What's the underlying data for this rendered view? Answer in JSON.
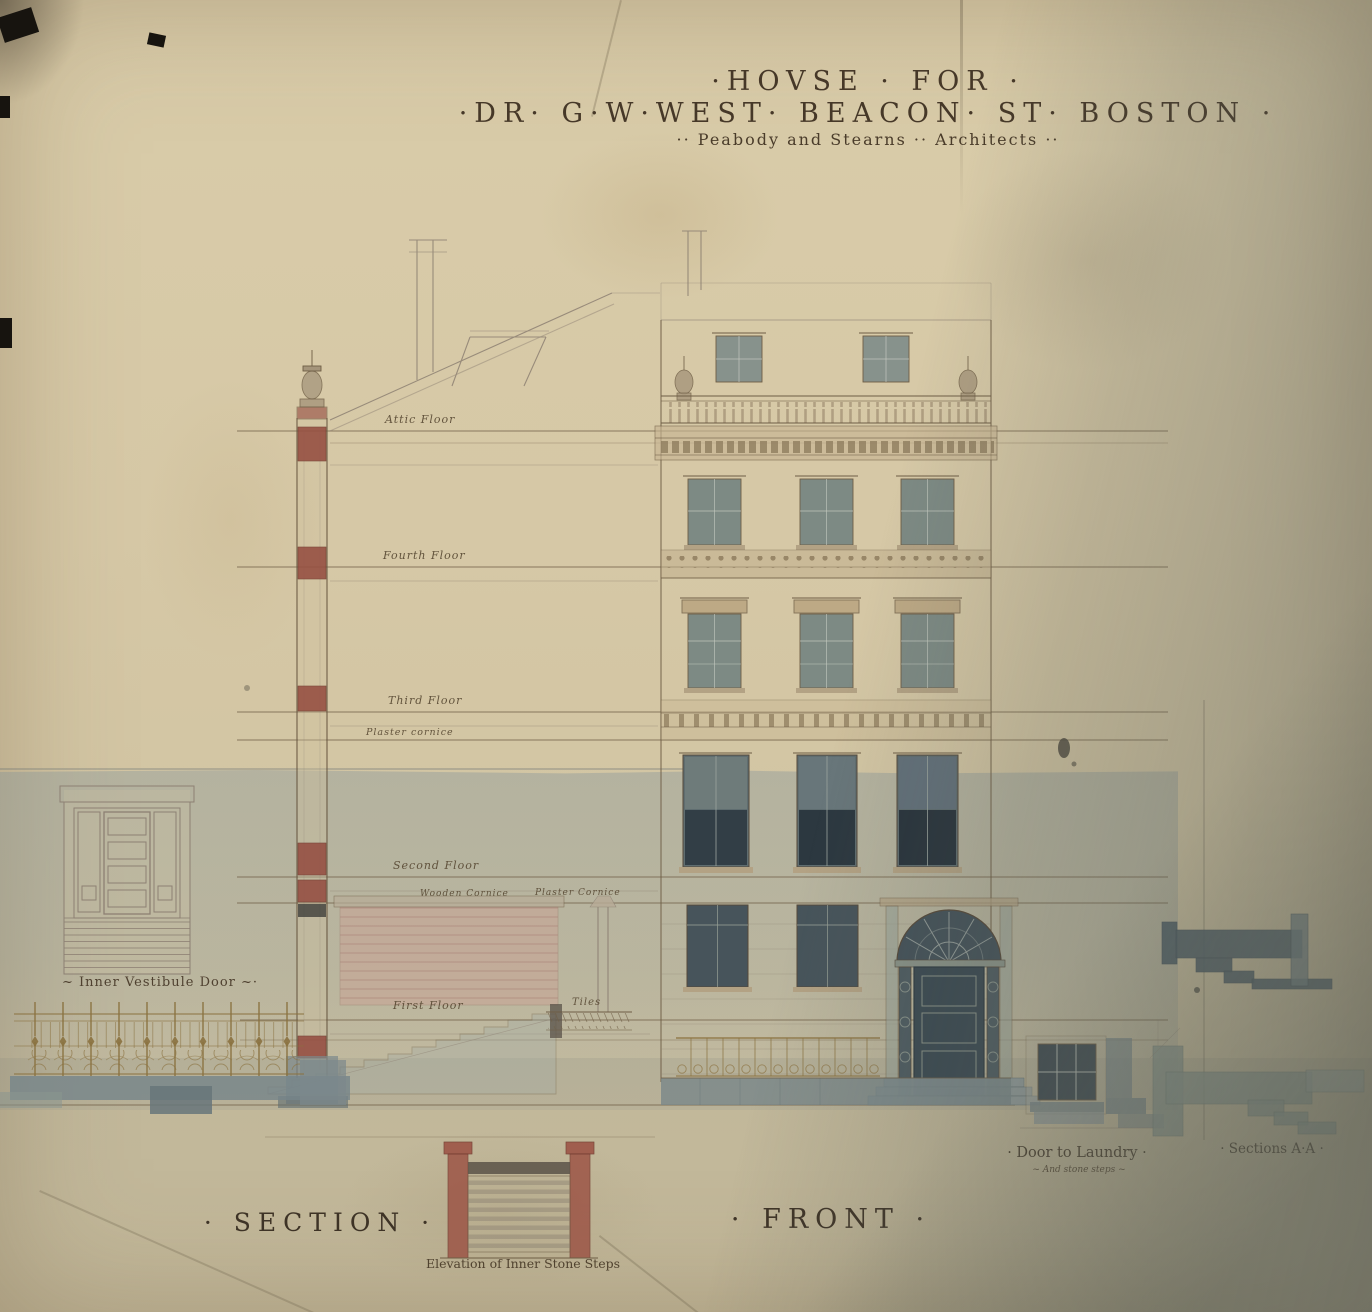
{
  "document": {
    "title_line1": "·HOVSE · FOR ·",
    "title_line2": "·DR· G·W·WEST·  BEACON· ST· BOSTON ·",
    "title_line3": "·· Peabody and Stearns ·· Architects ··"
  },
  "section_view": {
    "name_label": "· SECTION ·",
    "floor_labels": {
      "attic": "Attic Floor",
      "fourth": "Fourth Floor",
      "third": "Third Floor",
      "plaster_cornice": "Plaster cornice",
      "second": "Second Floor",
      "wooden_cornice": "Wooden Cornice",
      "plaster_cornice2": "Plaster Cornice",
      "first": "First Floor",
      "tiles": "Tiles"
    }
  },
  "front_view": {
    "name_label": "· FRONT ·"
  },
  "details": {
    "inner_vestibule_door_label": "~ Inner Vestibule Door ~·",
    "inner_stone_steps_label": "Elevation of Inner Stone Steps",
    "door_to_laundry_label": "· Door to Laundry ·",
    "door_to_laundry_sub_label": "~ And stone steps ~",
    "section_aa_label": "· Sections A·A ·"
  },
  "colors": {
    "paper": "#d6c8a6",
    "wash_blue": "#7a8e98",
    "ink_sepia": "#6e5d45",
    "pencil": "#8d8073",
    "brick_red": "#934a3e",
    "glass": "#7d8a84",
    "glass_dark": "#323e46",
    "stone_gray": "#79878a",
    "iron_brown": "#8a713f"
  }
}
